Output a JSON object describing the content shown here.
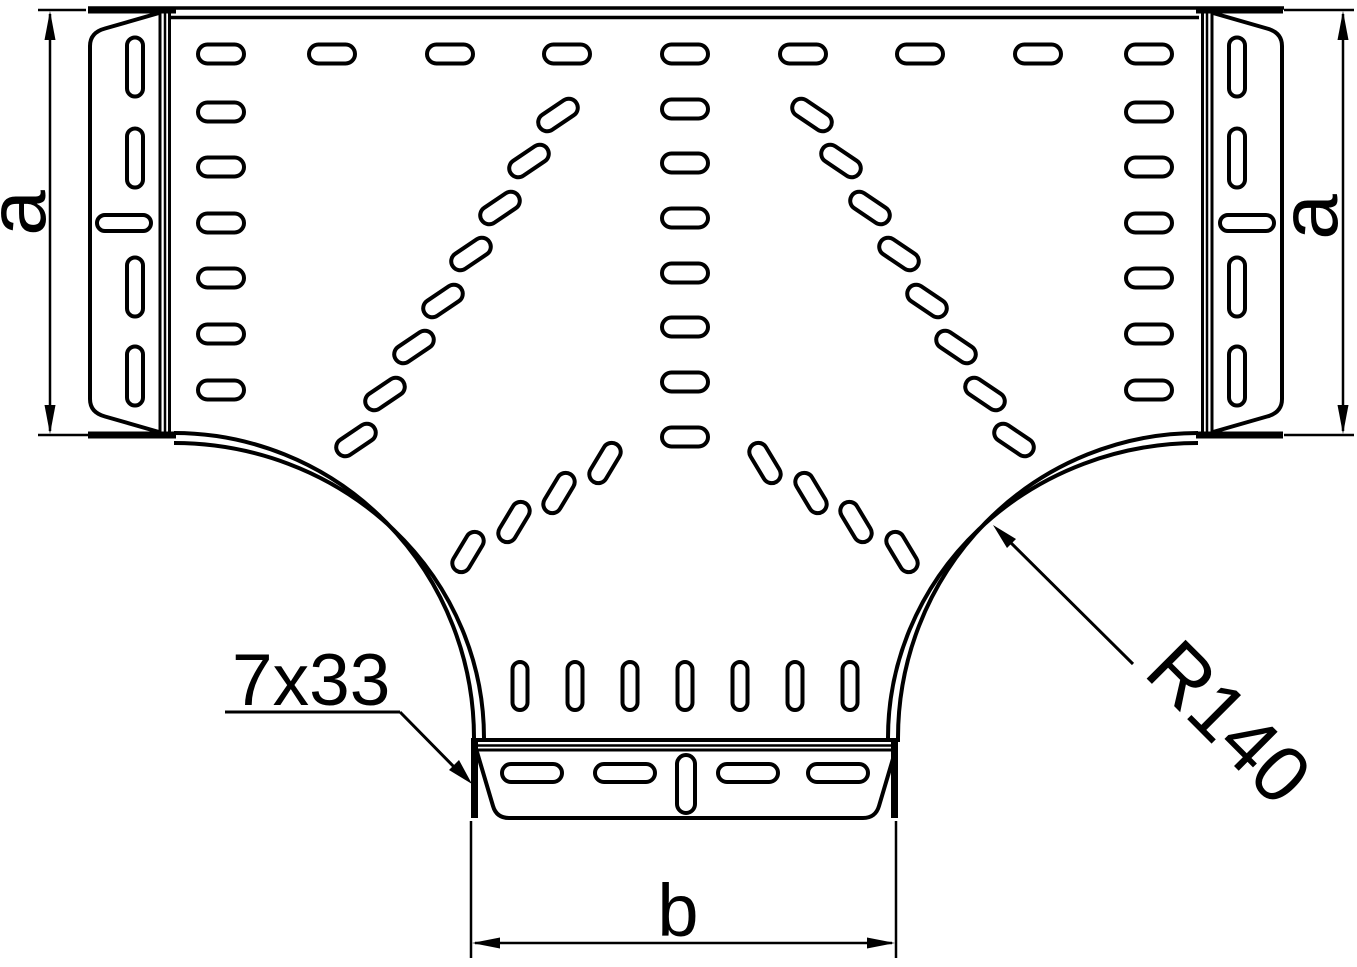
{
  "title": "Cable tray T-piece technical drawing",
  "labels": {
    "dim_left": "a",
    "dim_right": "a",
    "dim_bottom": "b",
    "slot_callout": "7x33",
    "radius_callout": "R140"
  },
  "colors": {
    "line": "#000000",
    "background": "#ffffff"
  },
  "perforations": {
    "groups": [
      {
        "name": "top-row",
        "w": 46,
        "h": 19,
        "rx": 9.5,
        "rot": 0,
        "points": [
          [
            221,
            54
          ],
          [
            332,
            54
          ],
          [
            450,
            54
          ],
          [
            567,
            54
          ],
          [
            685,
            54
          ],
          [
            803,
            54
          ],
          [
            920,
            54
          ],
          [
            1038,
            54
          ],
          [
            1149,
            54
          ]
        ]
      },
      {
        "name": "left-column",
        "w": 46,
        "h": 19,
        "rx": 9.5,
        "rot": 0,
        "points": [
          [
            221,
            112
          ],
          [
            221,
            167
          ],
          [
            221,
            223
          ],
          [
            221,
            278
          ],
          [
            221,
            334
          ],
          [
            221,
            390
          ]
        ]
      },
      {
        "name": "right-column",
        "w": 46,
        "h": 19,
        "rx": 9.5,
        "rot": 0,
        "points": [
          [
            1149,
            112
          ],
          [
            1149,
            167
          ],
          [
            1149,
            223
          ],
          [
            1149,
            278
          ],
          [
            1149,
            334
          ],
          [
            1149,
            390
          ]
        ]
      },
      {
        "name": "center-column",
        "w": 46,
        "h": 19,
        "rx": 9.5,
        "rot": 0,
        "points": [
          [
            685,
            109
          ],
          [
            685,
            163
          ],
          [
            685,
            218
          ],
          [
            685,
            273
          ],
          [
            685,
            327
          ],
          [
            685,
            382
          ],
          [
            685,
            437
          ]
        ]
      },
      {
        "name": "left-outer-fan",
        "w": 44,
        "h": 18,
        "rx": 9,
        "rot": -34,
        "points": [
          [
            558,
            115
          ],
          [
            529,
            161
          ],
          [
            500,
            208
          ],
          [
            471,
            254
          ],
          [
            443,
            301
          ],
          [
            414,
            347
          ],
          [
            385,
            394
          ],
          [
            356,
            440
          ]
        ]
      },
      {
        "name": "right-outer-fan",
        "w": 44,
        "h": 18,
        "rx": 9,
        "rot": 34,
        "points": [
          [
            812,
            115
          ],
          [
            841,
            161
          ],
          [
            870,
            208
          ],
          [
            899,
            254
          ],
          [
            927,
            301
          ],
          [
            956,
            347
          ],
          [
            985,
            394
          ],
          [
            1014,
            440
          ]
        ]
      },
      {
        "name": "left-inner-fan",
        "w": 44,
        "h": 18,
        "rx": 9,
        "rot": -59,
        "points": [
          [
            605,
            463
          ],
          [
            559,
            493
          ],
          [
            514,
            522
          ],
          [
            468,
            552
          ]
        ]
      },
      {
        "name": "right-inner-fan",
        "w": 44,
        "h": 18,
        "rx": 9,
        "rot": 59,
        "points": [
          [
            765,
            463
          ],
          [
            811,
            493
          ],
          [
            856,
            522
          ],
          [
            902,
            552
          ]
        ]
      },
      {
        "name": "branch-row",
        "w": 15,
        "h": 48,
        "rx": 7.5,
        "rot": 0,
        "points": [
          [
            520,
            686
          ],
          [
            575,
            686
          ],
          [
            630,
            686
          ],
          [
            685,
            686
          ],
          [
            740,
            686
          ],
          [
            795,
            686
          ],
          [
            850,
            686
          ]
        ]
      },
      {
        "name": "left-flange-vslot",
        "w": 16,
        "h": 59,
        "rx": 8,
        "rot": 0,
        "points": [
          [
            135,
            67
          ],
          [
            135,
            158
          ],
          [
            135,
            287
          ],
          [
            135,
            376
          ]
        ]
      },
      {
        "name": "right-flange-vslot",
        "w": 16,
        "h": 59,
        "rx": 8,
        "rot": 0,
        "points": [
          [
            1237,
            67
          ],
          [
            1237,
            158
          ],
          [
            1237,
            287
          ],
          [
            1237,
            376
          ]
        ]
      },
      {
        "name": "flange-hslot",
        "w": 54,
        "h": 16,
        "rx": 8,
        "rot": 0,
        "points": [
          [
            124,
            223
          ],
          [
            1247,
            223
          ]
        ]
      },
      {
        "name": "bottom-flange-hslot",
        "w": 60,
        "h": 18,
        "rx": 9,
        "rot": 0,
        "points": [
          [
            532,
            773
          ],
          [
            625,
            773
          ],
          [
            748,
            773
          ],
          [
            838,
            773
          ]
        ]
      },
      {
        "name": "bottom-flange-vslot",
        "w": 18,
        "h": 58,
        "rx": 9,
        "rot": 0,
        "points": [
          [
            686,
            784
          ]
        ]
      }
    ]
  }
}
